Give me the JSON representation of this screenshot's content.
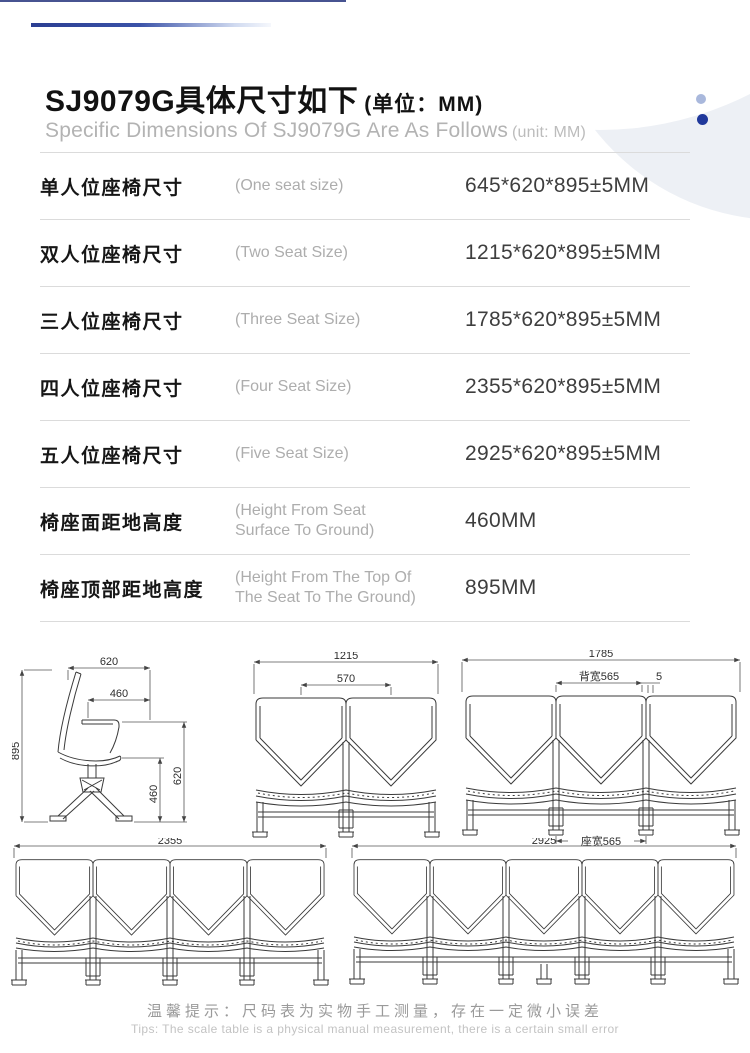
{
  "header": {
    "title_cn": "SJ9079G具体尺寸如下",
    "title_unit": "(单位：MM)",
    "subtitle_en": "Specific Dimensions Of SJ9079G Are As Follows",
    "subtitle_unit": "(unit: MM)"
  },
  "accent_color": "#2b3e92",
  "dot_colors": {
    "light": "#a9b8dc",
    "dark": "#20389b"
  },
  "table": {
    "rows": [
      {
        "label_cn": "单人位座椅尺寸",
        "label_en": "(One seat size)",
        "value": "645*620*895±5MM"
      },
      {
        "label_cn": "双人位座椅尺寸",
        "label_en": "(Two Seat Size)",
        "value": "1215*620*895±5MM"
      },
      {
        "label_cn": "三人位座椅尺寸",
        "label_en": "(Three Seat Size)",
        "value": "1785*620*895±5MM"
      },
      {
        "label_cn": "四人位座椅尺寸",
        "label_en": "(Four Seat Size)",
        "value": "2355*620*895±5MM"
      },
      {
        "label_cn": "五人位座椅尺寸",
        "label_en": "(Five Seat Size)",
        "value": "2925*620*895±5MM"
      },
      {
        "label_cn": "椅座面距地高度",
        "label_en": "(Height From Seat\nSurface To Ground)",
        "value": "460MM"
      },
      {
        "label_cn": "椅座顶部距地高度",
        "label_en": "(Height From The Top Of\n The Seat To The Ground)",
        "value": "895MM"
      }
    ]
  },
  "drawings": {
    "side": {
      "top": "620",
      "inner_top": "460",
      "left": "895",
      "inner_right": "460",
      "right": "620"
    },
    "two": {
      "total": "1215",
      "pitch": "570"
    },
    "three": {
      "total": "1785",
      "back": "背宽565",
      "gap": "5",
      "seat": "座宽565"
    },
    "four": {
      "total": "2355"
    },
    "five": {
      "total": "2925"
    }
  },
  "footer": {
    "cn": "温馨提示：尺码表为实物手工测量，存在一定微小误差",
    "en": "Tips: The scale table is a physical manual measurement, there is a certain small error"
  }
}
